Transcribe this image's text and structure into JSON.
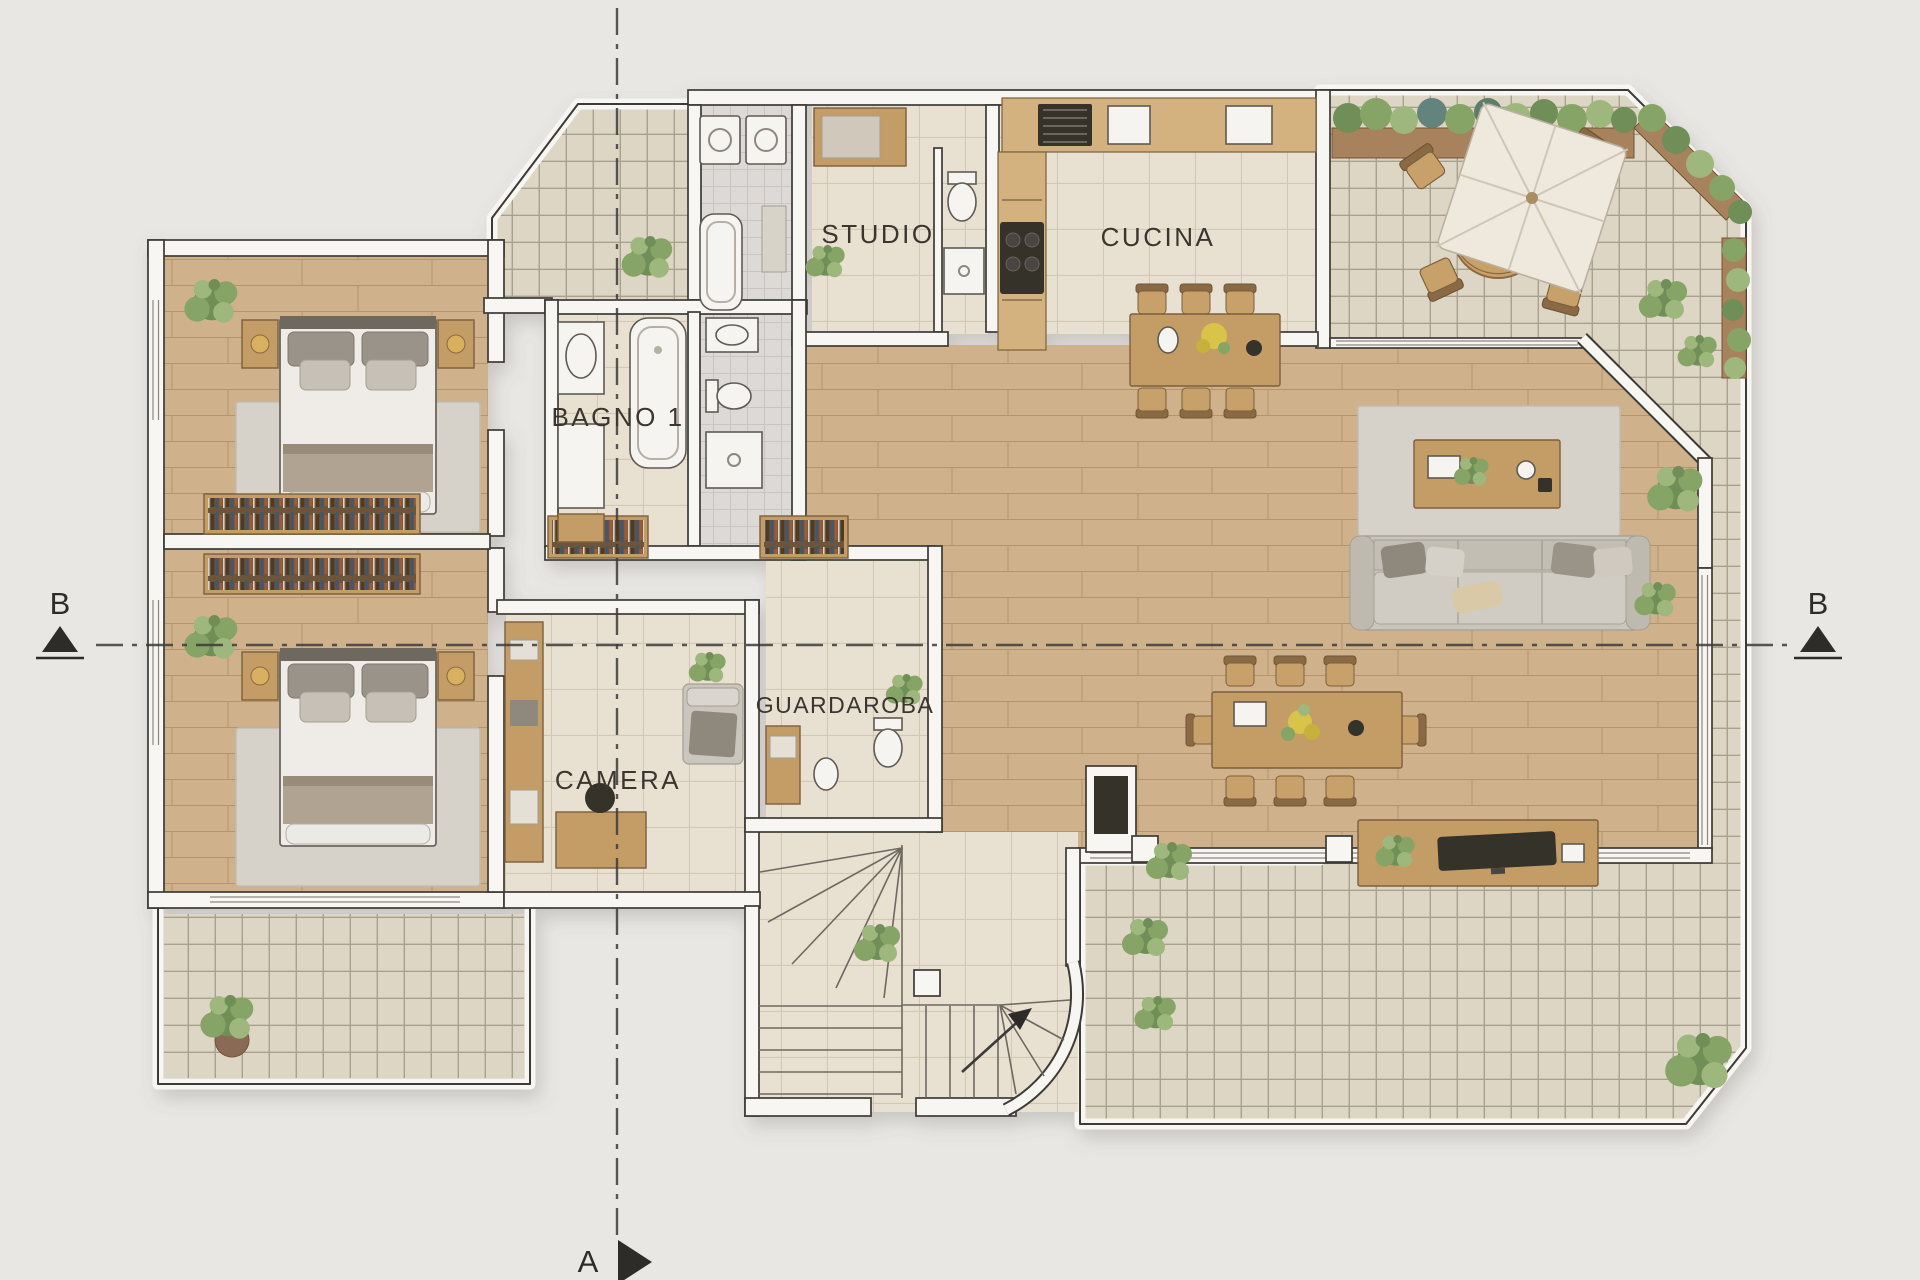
{
  "document": {
    "type": "architectural floor plan",
    "view": "top-down rendered plan"
  },
  "rooms": {
    "studio": "STUDIO",
    "cucina": "CUCINA",
    "bagno1": "BAGNO 1",
    "camera": "CAMERA",
    "guardaroba": "GUARDAROBA"
  },
  "section_markers": {
    "left": "B",
    "right": "B",
    "bottom": "A"
  },
  "colors": {
    "background": "#e9e7e4",
    "wall_fill": "#f8f6f2",
    "wall_stroke": "#3e3a35",
    "wood": "#cfb28c",
    "wood_line": "#b5946c",
    "tile_room": "#e8e0d1",
    "tile_room_line": "#d2c8b4",
    "tile_deck": "#ded6c5",
    "tile_deck_line": "#a9a08e",
    "tile_bath": "#dcd9d6",
    "tile_bath_line": "#c9c6c2",
    "rug": "#d6d2ca",
    "fabric": "#cbc6bd",
    "wood_furniture": "#c49c66",
    "wood_furniture_dark": "#7c5f3c",
    "white_fixture": "#f6f4f0",
    "accent_dark": "#35312c",
    "plant_dark": "#6f8e58",
    "plant_mid": "#85a466",
    "plant_light": "#9db77c",
    "label_text": "#3a352e",
    "marker": "#2e2c29"
  }
}
